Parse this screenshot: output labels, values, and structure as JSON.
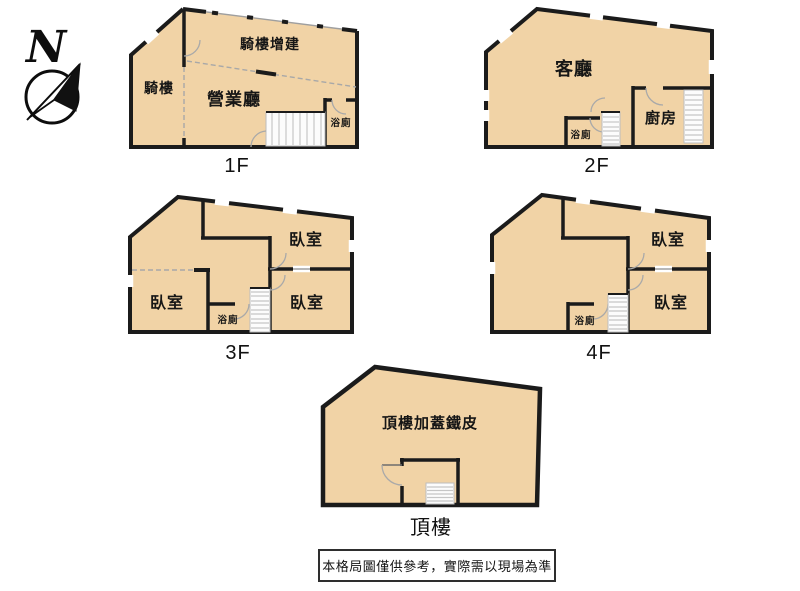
{
  "compass": {
    "north_label": "N"
  },
  "colors": {
    "floor_fill": "#F1D3A6",
    "wall": "#1b1b1b",
    "thin_line": "#9f9f9f",
    "stair_fill": "#fcfcfc",
    "background": "#ffffff"
  },
  "floors": [
    {
      "label": "1F",
      "rooms": {
        "arcade_addition": "騎樓增建",
        "arcade": "騎樓",
        "business_hall": "營業廳",
        "bath": "浴廁"
      }
    },
    {
      "label": "2F",
      "rooms": {
        "living_room": "客廳",
        "kitchen": "廚房",
        "bath": "浴廁"
      }
    },
    {
      "label": "3F",
      "rooms": {
        "bedroom_a": "臥室",
        "bedroom_b": "臥室",
        "bedroom_c": "臥室",
        "bath": "浴廁"
      }
    },
    {
      "label": "4F",
      "rooms": {
        "bedroom_a": "臥室",
        "bedroom_b": "臥室",
        "bath": "浴廁"
      }
    },
    {
      "label": "頂樓",
      "rooms": {
        "rooftop_addition": "頂樓加蓋鐵皮"
      }
    }
  ],
  "disclaimer": "本格局圖僅供參考，實際需以現場為準"
}
